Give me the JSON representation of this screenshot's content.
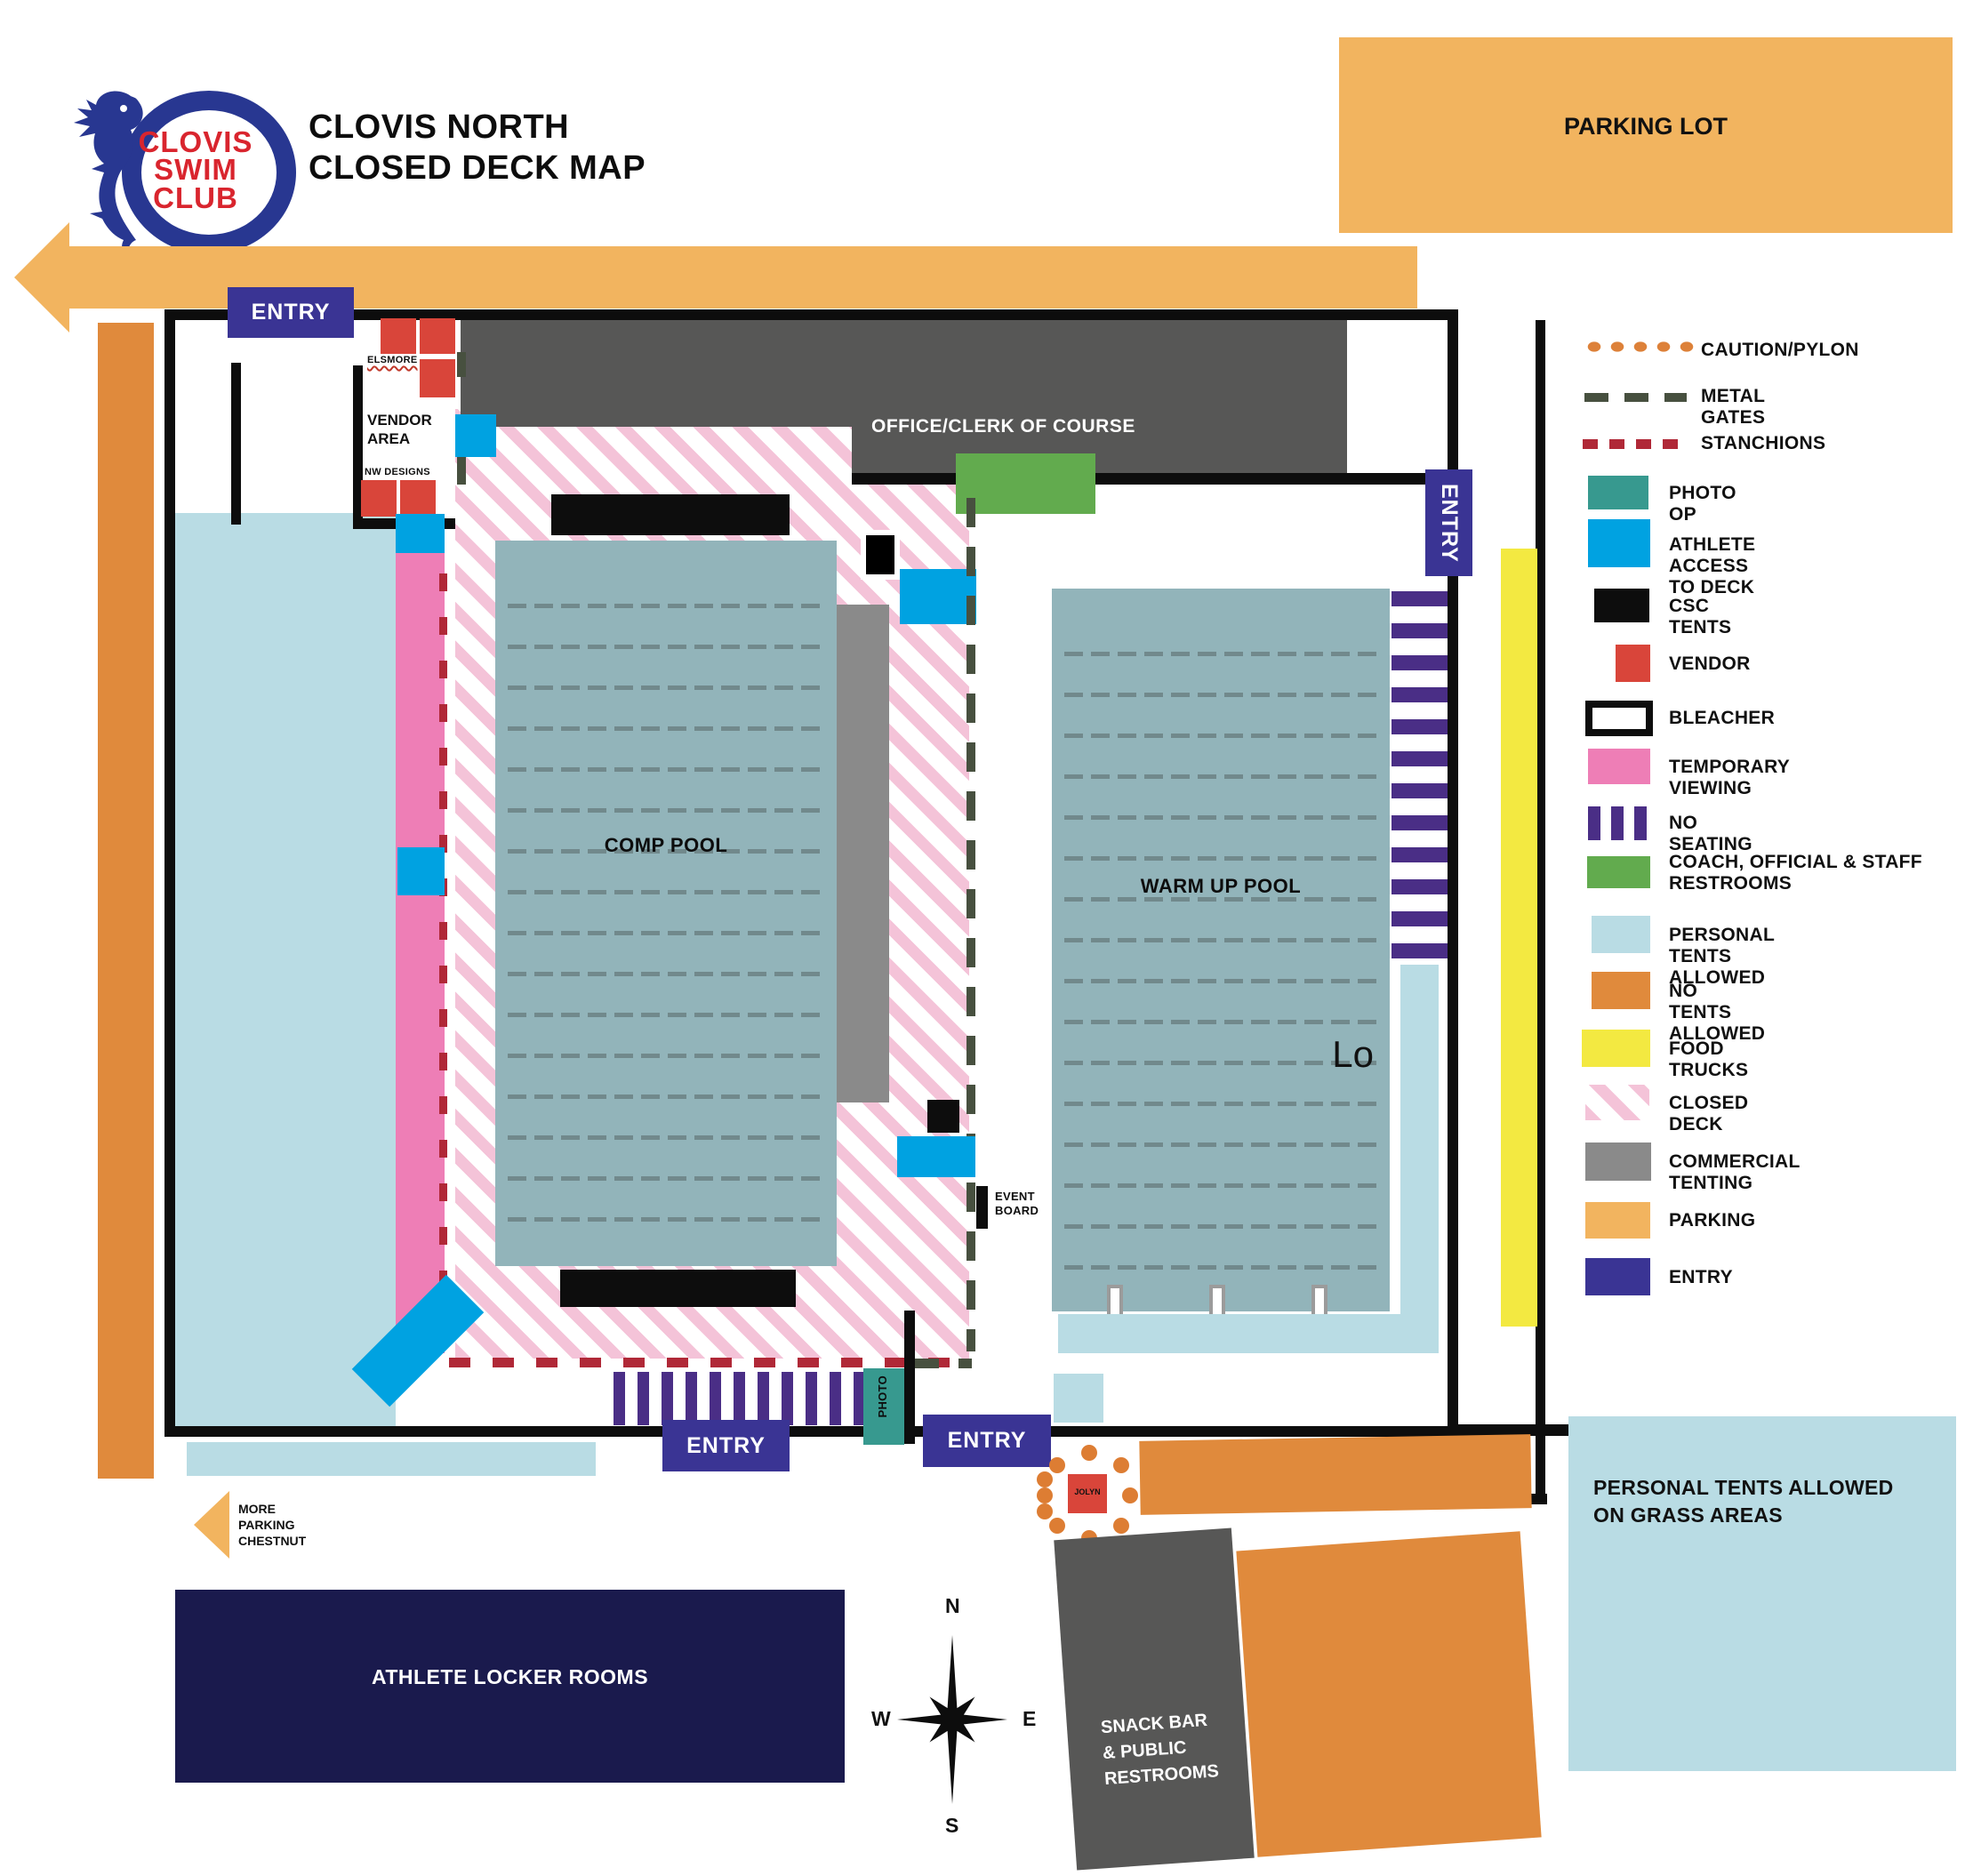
{
  "header": {
    "logo": {
      "line1": "CLOVIS",
      "line2": "SWIM",
      "line3": "CLUB"
    },
    "title_line1": "CLOVIS NORTH",
    "title_line2": "CLOSED DECK MAP"
  },
  "parking_lot_label": "PARKING LOT",
  "map": {
    "entry_top": "ENTRY",
    "entry_right": "ENTRY",
    "entry_bottom_left": "ENTRY",
    "entry_bottom_right": "ENTRY",
    "vendor": {
      "elsmore": "ELSMORE",
      "area_line1": "VENDOR",
      "area_line2": "AREA",
      "nw_designs": "NW DESIGNS"
    },
    "office_label": "OFFICE/CLERK OF COURSE",
    "comp_pool_label": "COMP POOL",
    "warm_up_pool_label": "WARM UP POOL",
    "lo_label": "Lo",
    "event_board_line1": "EVENT",
    "event_board_line2": "BOARD",
    "photo_label": "PHOTO",
    "jolyn_label": "JOLYN",
    "more_parking": [
      "MORE",
      "PARKING",
      "CHESTNUT"
    ],
    "athlete_locker_label": "ATHLETE LOCKER ROOMS",
    "snack_bar": [
      "SNACK BAR",
      "& PUBLIC",
      "RESTROOMS"
    ],
    "grass_line1": "PERSONAL TENTS ALLOWED",
    "grass_line2": "ON GRASS AREAS",
    "compass": {
      "n": "N",
      "e": "E",
      "s": "S",
      "w": "W"
    }
  },
  "legend": {
    "items": [
      {
        "label": "CAUTION/PYLON",
        "color": "#dd8139",
        "type": "dots"
      },
      {
        "label": "METAL GATES",
        "color": "#47503f",
        "type": "dashes"
      },
      {
        "label": "STANCHIONS",
        "color": "#b02837",
        "type": "dashes"
      },
      {
        "label": "PHOTO OP",
        "color": "#37998f",
        "type": "solid"
      },
      {
        "label": "ATHLETE ACCESS TO DECK",
        "color": "#00a2e1",
        "type": "solid"
      },
      {
        "label": "CSC TENTS",
        "color": "#000000",
        "type": "solid"
      },
      {
        "label": "VENDOR",
        "color": "#d9453a",
        "type": "solid"
      },
      {
        "label": "BLEACHER",
        "color": "#ffffff",
        "type": "outline"
      },
      {
        "label": "TEMPORARY VIEWING",
        "color": "#ee7eb6",
        "type": "solid"
      },
      {
        "label": "NO SEATING",
        "color": "#4a2e86",
        "type": "bars"
      },
      {
        "label": "COACH, OFFICIAL & STAFF RESTROOMS",
        "color": "#62ab4e",
        "type": "solid"
      },
      {
        "label": "PERSONAL TENTS ALLOWED",
        "color": "#b9dce4",
        "type": "solid"
      },
      {
        "label": "NO TENTS ALLOWED",
        "color": "#e08a3c",
        "type": "solid"
      },
      {
        "label": "FOOD TRUCKS",
        "color": "#f3e941",
        "type": "solid"
      },
      {
        "label": "CLOSED DECK",
        "color": "#f4c3d8",
        "type": "stripes"
      },
      {
        "label": "COMMERCIAL TENTING",
        "color": "#8a8a8a",
        "type": "solid"
      },
      {
        "label": "PARKING",
        "color": "#f2b45f",
        "type": "solid"
      },
      {
        "label": "ENTRY",
        "color": "#3a3494",
        "type": "solid"
      }
    ]
  }
}
